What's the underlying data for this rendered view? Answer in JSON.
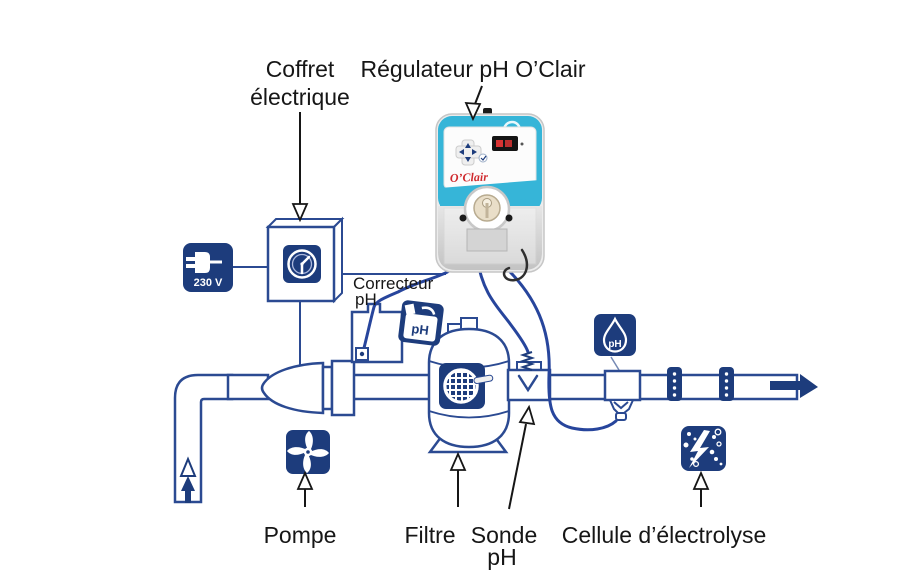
{
  "colors": {
    "navy": "#1d3c7c",
    "pipe_blue": "#2b4a92",
    "tube_blue": "#27459c",
    "device_cyan": "#36b5d8",
    "logo_red": "#cf2a2e",
    "label_black": "#161616"
  },
  "labels": {
    "coffret_line1": "Coffret",
    "coffret_line2": "électrique",
    "regulateur": "Régulateur pH O’Clair",
    "correcteur_line1": "Correcteur",
    "correcteur_line2": "pH",
    "pompe": "Pompe",
    "filtre": "Filtre",
    "sonde_line1": "Sonde",
    "sonde_line2": "pH",
    "cellule": "Cellule d’électrolyse"
  },
  "badges": {
    "voltage": "230 V",
    "canister_ph": "pH",
    "drop_ph": "pH",
    "device_logo": "O’Clair"
  },
  "icons": {
    "plug": "plug-230v-icon",
    "clock": "clock-icon",
    "fan": "pump-fan-icon",
    "sieve": "filter-sieve-icon",
    "canister": "ph-canister-icon",
    "drop": "ph-drop-icon",
    "electrolysis": "electrolysis-icon"
  }
}
